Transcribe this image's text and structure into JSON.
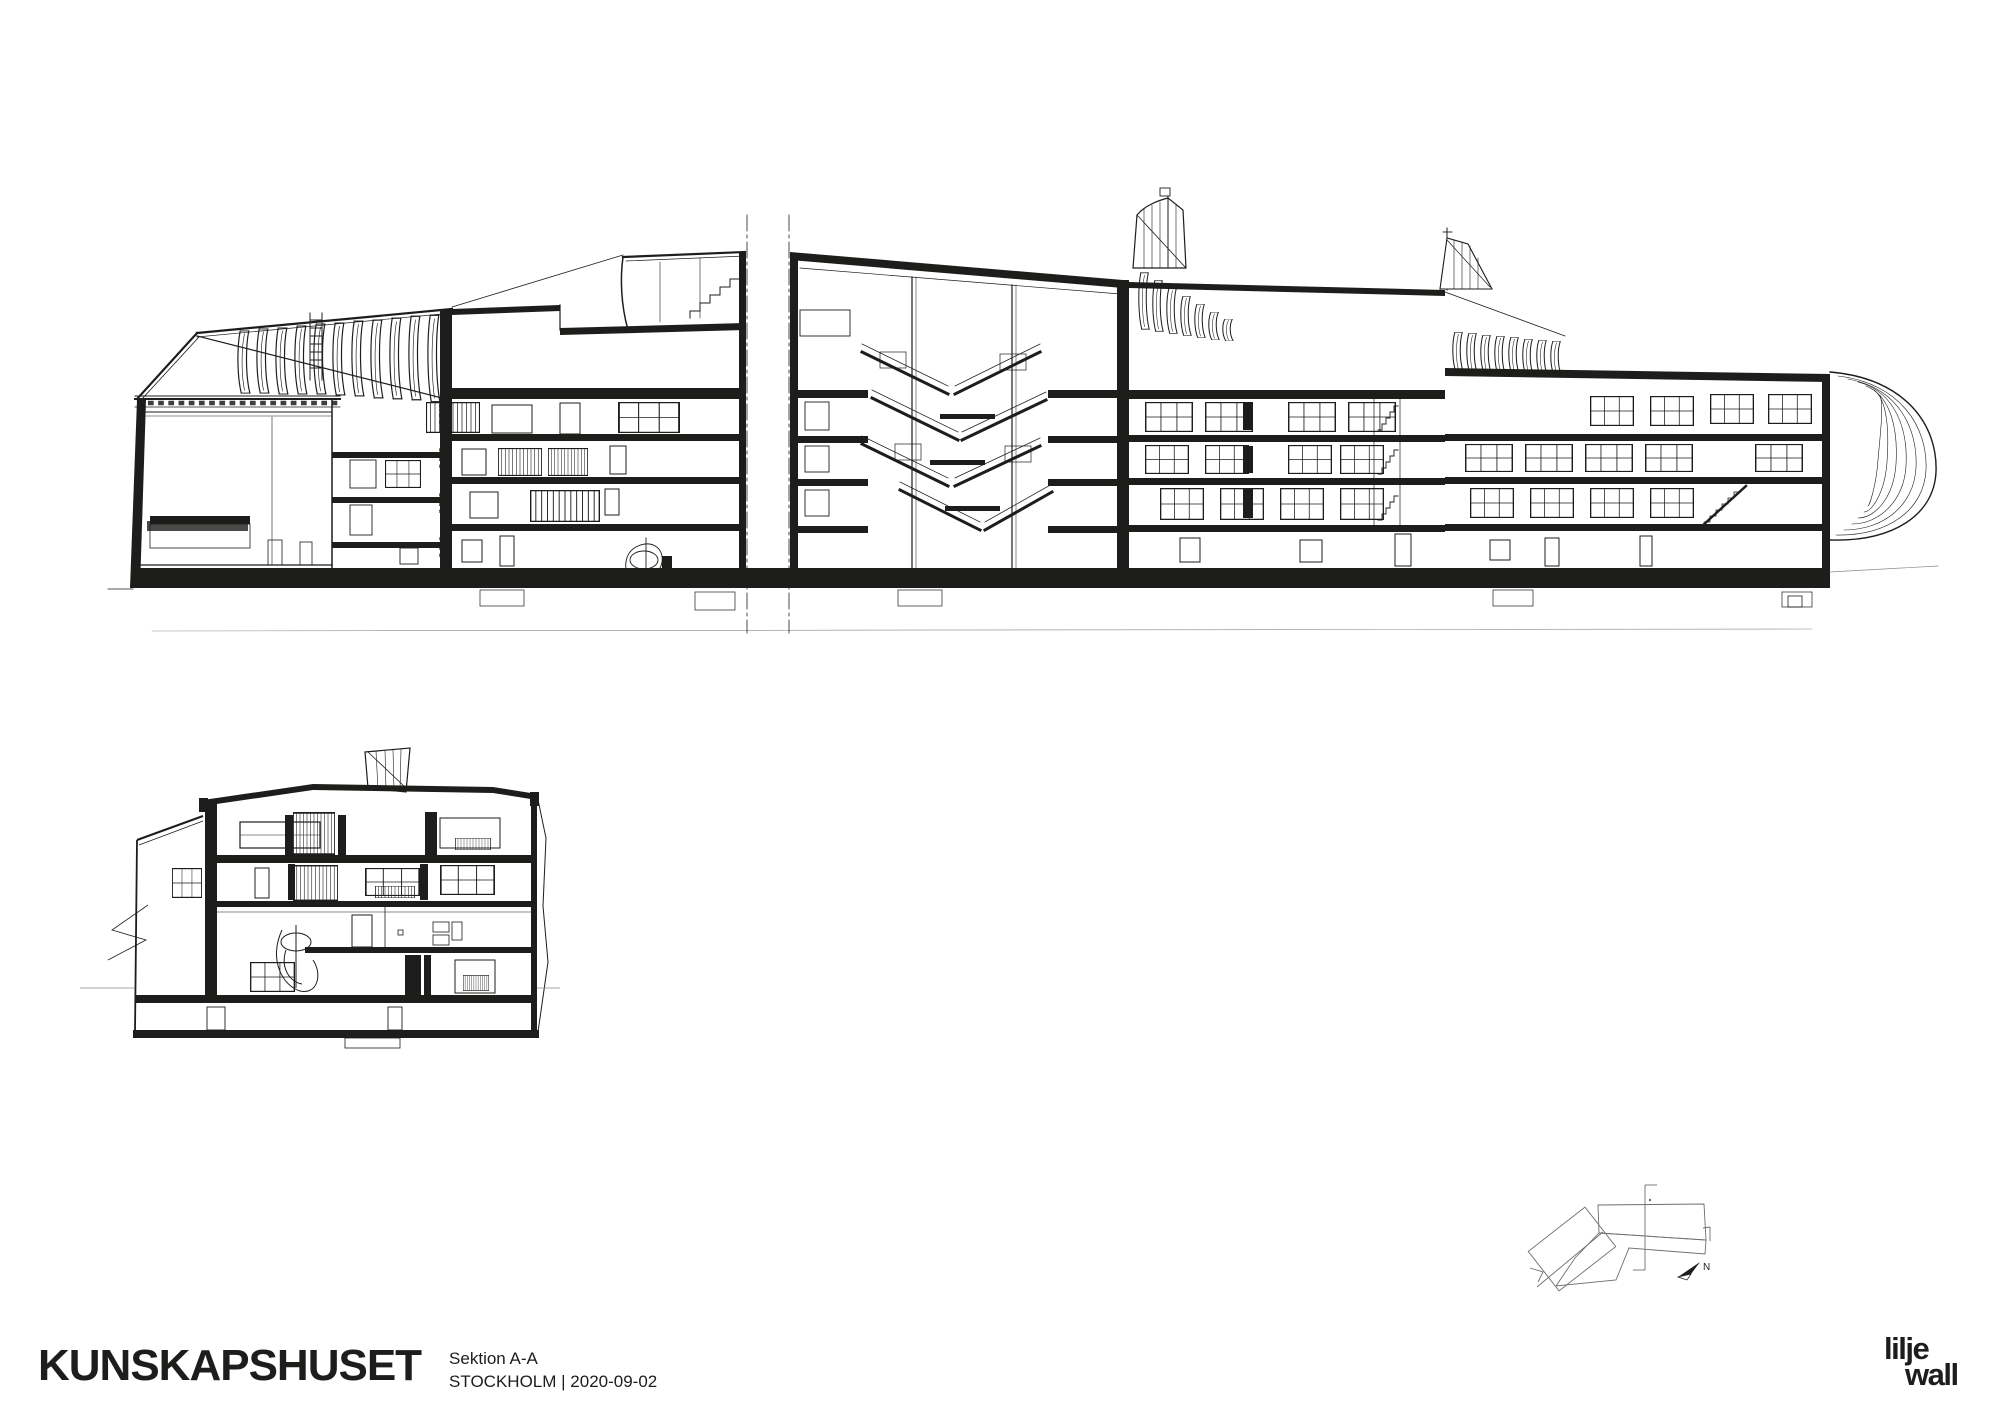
{
  "sheet": {
    "project_title": "KUNSKAPSHUSET",
    "drawing_title": "Sektion A-A",
    "location_date_line": "STOCKHOLM | 2020-09-02",
    "logo_line1": "lilje",
    "logo_line2": "wall"
  },
  "long_section": {
    "dimension_labels": [
      "3 545",
      "3 565",
      "3 565",
      "3 250"
    ]
  },
  "key_plan": {
    "north_label": "N"
  },
  "icons": {
    "north_arrow": "north-arrow-icon",
    "section_cut_line": "section-line-icon"
  },
  "colors": {
    "ink": "#1d1d1b",
    "paper": "#ffffff",
    "light_line": "#8a8a8a"
  }
}
